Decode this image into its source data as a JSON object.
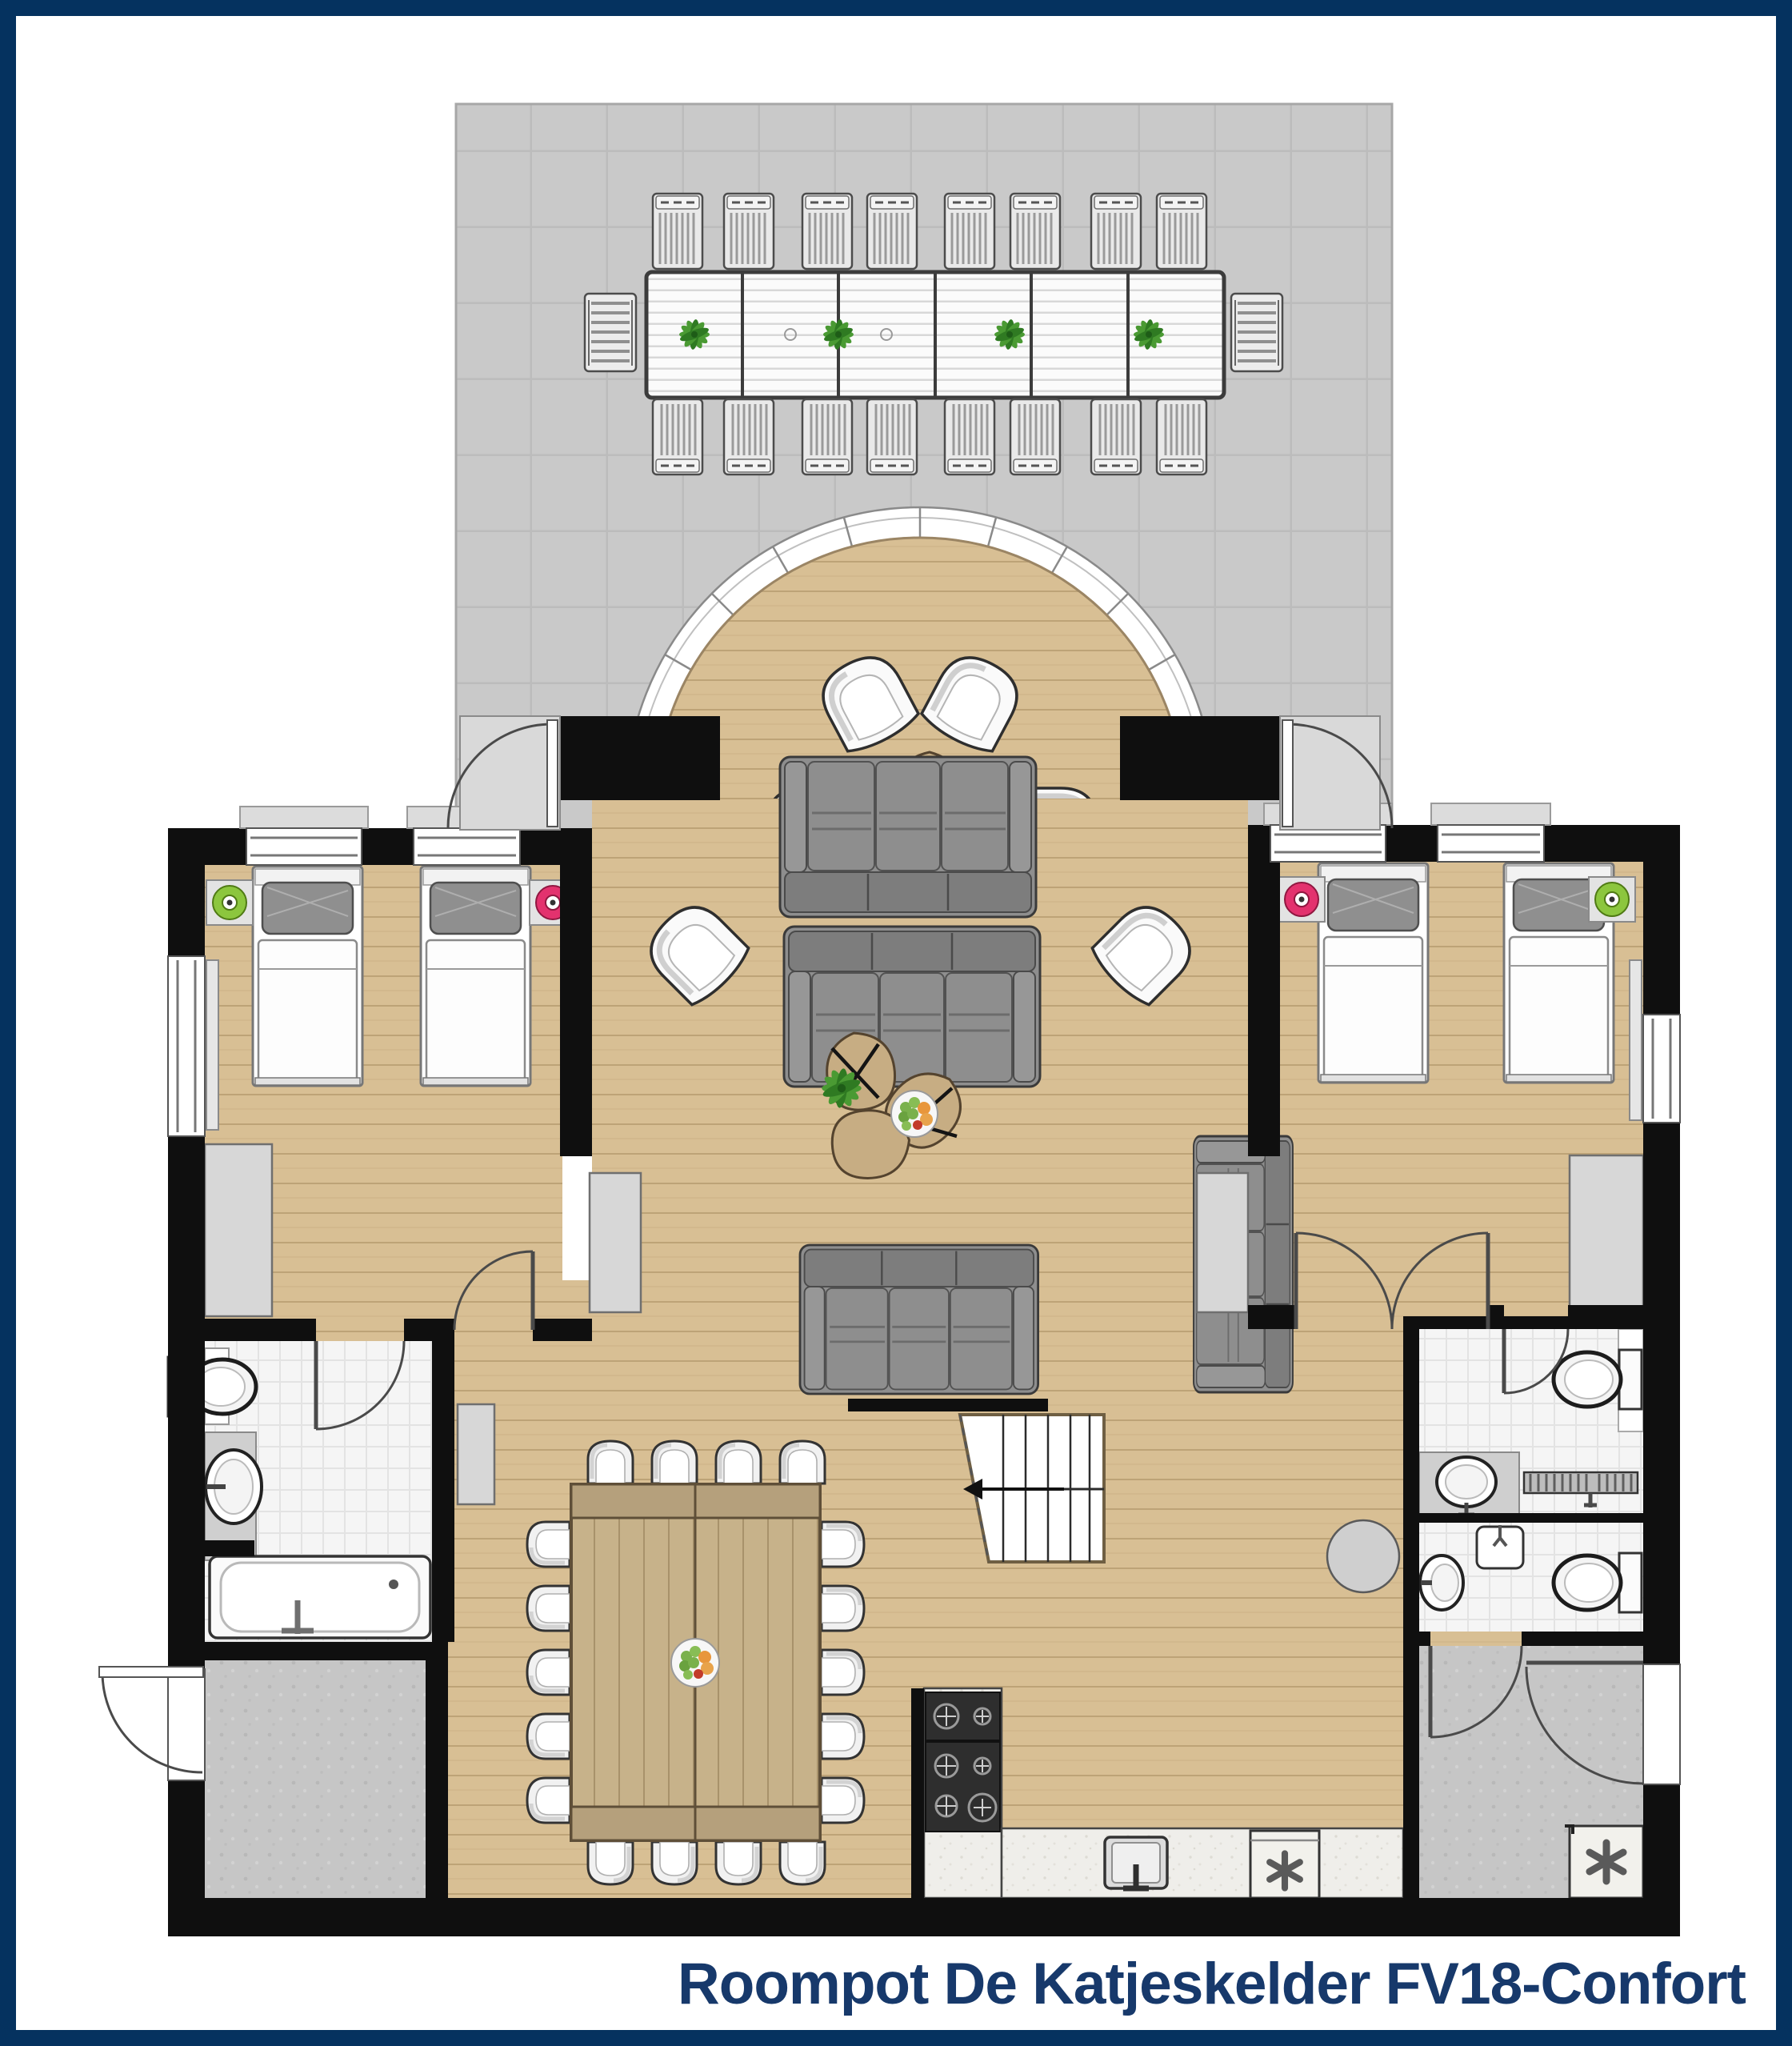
{
  "title": {
    "text": "Roompot De Katjeskelder FV18-Confort"
  },
  "colors": {
    "navy": "#05325f",
    "titleNavy": "#17396b",
    "wall": "#0f0f0f",
    "wood": "#d8bf94",
    "terrace": "#c9c9c9",
    "bathTile": "#f5f5f5",
    "floorGray": "#c6c6c6",
    "counter": "#efeeea",
    "sofa": "#8e8e8e",
    "accentGreen": "#8cc63e",
    "accentPink": "#e3326e",
    "plantGreen": "#4a9a33"
  },
  "plan": {
    "type": "holiday-home floor plan, top-down view",
    "rooms": [
      "terrace",
      "semicircular deck",
      "living-room",
      "bedroom-left",
      "bedroom-right",
      "bathroom-left",
      "bathroom-right-top",
      "bathroom-right-bottom",
      "entrance-hall",
      "utility-room",
      "dining-area",
      "kitchen"
    ],
    "furniture_counts": {
      "sun_loungers": 16,
      "terrace_benches": 2,
      "outdoor_table_sections": 6,
      "deck_armchairs": 4,
      "living_room_sofas": 4,
      "living_room_armchairs": 2,
      "coffee_tables": 3,
      "single_beds": 4,
      "nightstand_discs_green": 2,
      "nightstand_discs_pink": 2,
      "dining_chairs": 18,
      "toilets": 3,
      "washbasins": 4,
      "bathtubs": 1,
      "gas_hob_modules": 2,
      "asterisk_appliances": 2,
      "staircase": 1
    }
  }
}
